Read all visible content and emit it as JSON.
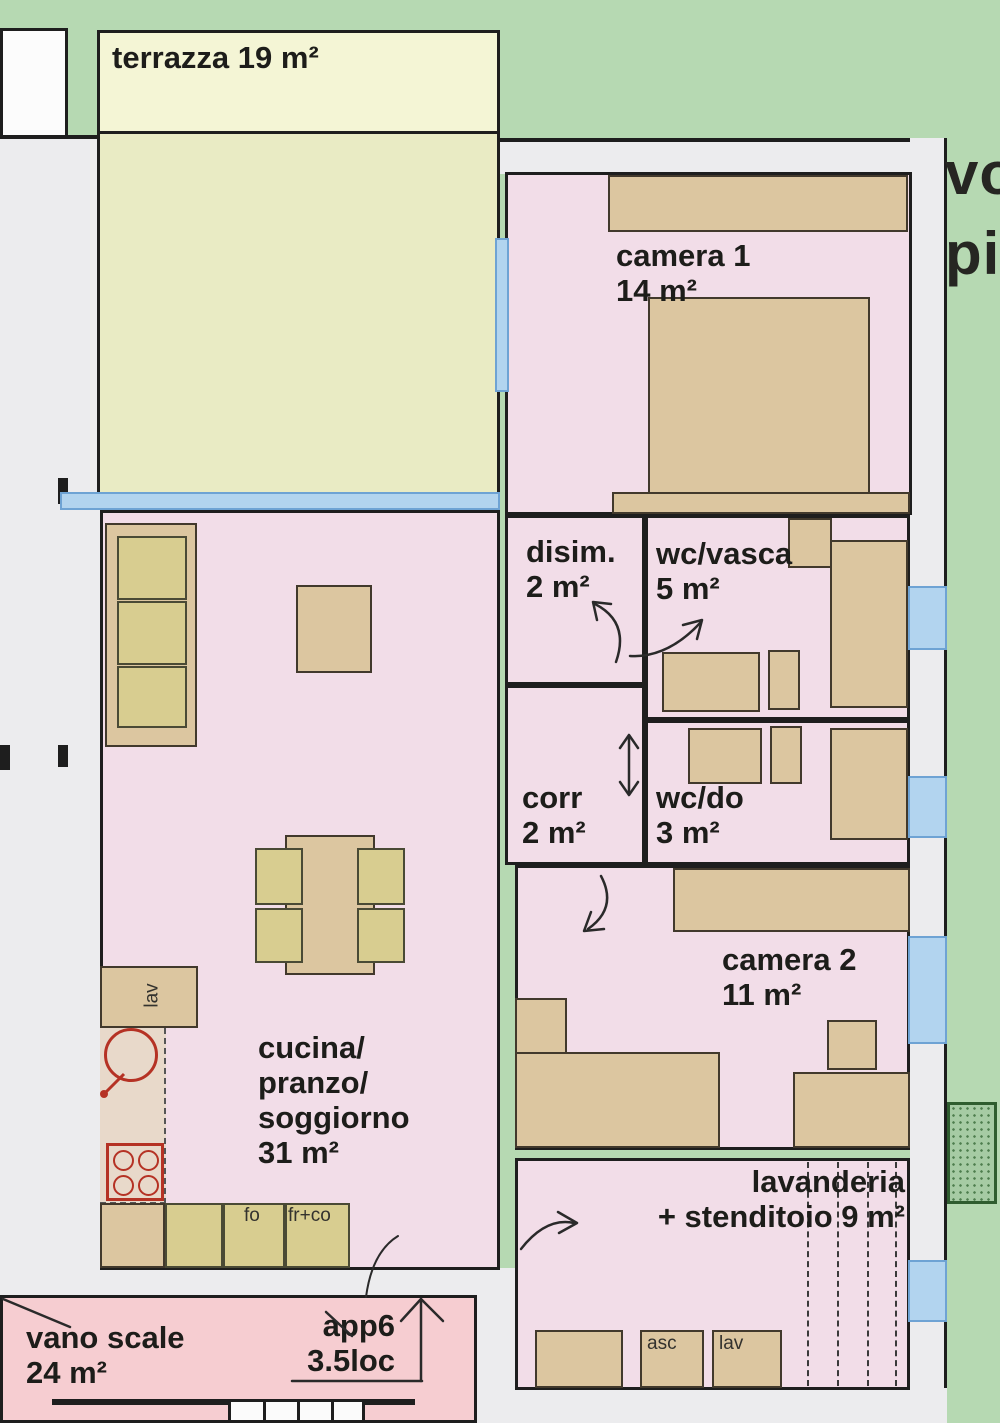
{
  "plan_title": "apartment floor plan",
  "rooms": {
    "terrazza": {
      "label": "terrazza 19 m²"
    },
    "camera1": {
      "line1": "camera 1",
      "line2": "14 m²"
    },
    "disimpegno": {
      "line1": "disim.",
      "line2": "2 m²"
    },
    "wc_vasca": {
      "line1": "wc/vasca",
      "line2": "5 m²"
    },
    "corridoio": {
      "line1": "corr",
      "line2": "2 m²"
    },
    "wc_doccia": {
      "line1": "wc/do",
      "line2": "3 m²"
    },
    "camera2": {
      "line1": "camera 2",
      "line2": "11 m²"
    },
    "cucina": {
      "line1": "cucina/",
      "line2": "pranzo/",
      "line3": "soggiorno",
      "line4": "31 m²"
    },
    "lavanderia": {
      "line1": "lavanderia",
      "line2": "+ stenditoio 9 m²"
    },
    "vano_scale": {
      "line1": "vano scale",
      "line2": "24 m²"
    }
  },
  "apartment": {
    "name": "app6",
    "size": "3.5loc"
  },
  "kitchen_labels": {
    "sink": "lav",
    "oven": "fo",
    "fridge": "fr+co"
  },
  "service_labels": {
    "elevator": "asc",
    "washer": "lav"
  },
  "edge_text": {
    "line1": "vo",
    "line2": "pia"
  },
  "colors": {
    "background_green": "#b6d9b2",
    "room_pink": "#f2dde8",
    "stairwell_pink": "#f6cdd1",
    "terrace_cream": "#f4f5d5",
    "terrace_floor": "#e9ebc4",
    "furniture_tan": "#dcc6a0",
    "furniture_khaki": "#d8cd90",
    "window_blue": "#b2d4ef",
    "outer_grey": "#ececee",
    "planter_green": "#a6cba4",
    "wall_dark": "#1e1e1e",
    "fixture_red": "#b53224"
  }
}
